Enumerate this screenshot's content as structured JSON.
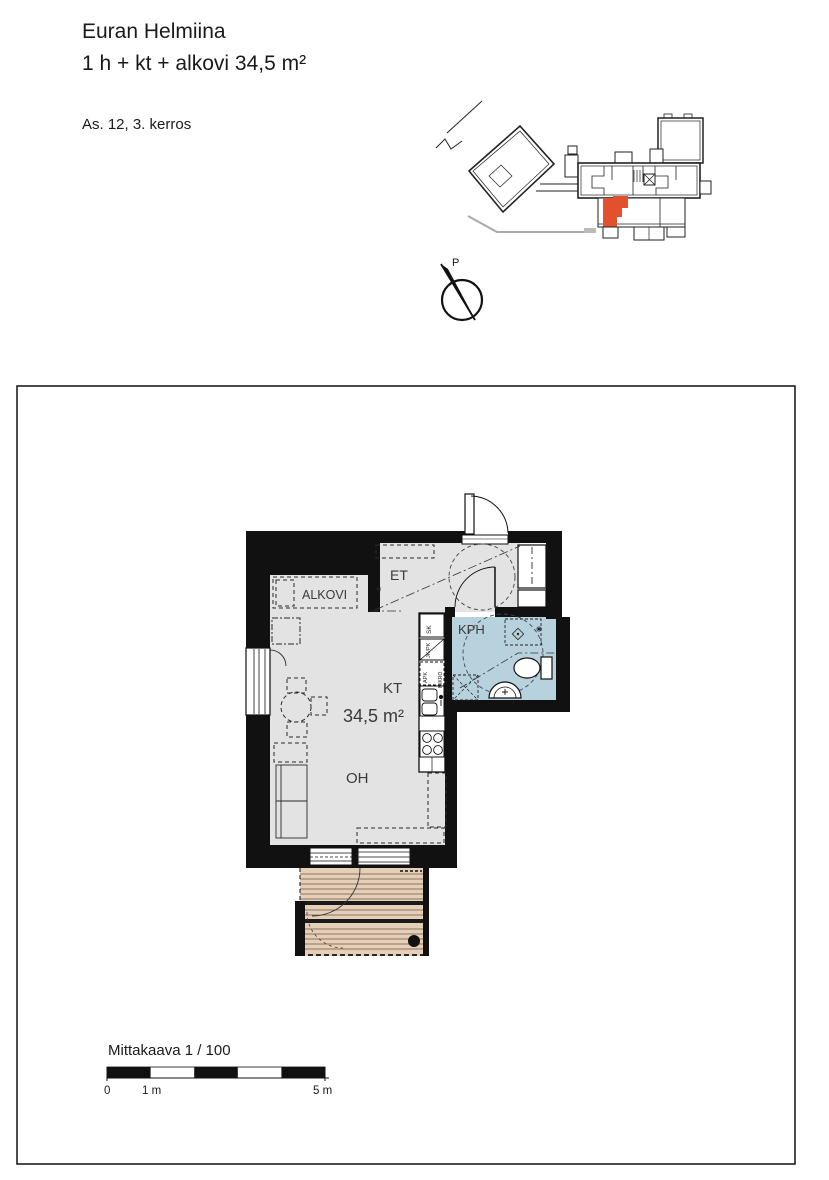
{
  "header": {
    "title": "Euran Helmiina",
    "subtitle": "1 h + kt + alkovi 34,5 m²",
    "unit_info": "As. 12, 3. kerros"
  },
  "site_plan": {
    "north_label": "P"
  },
  "floor_plan": {
    "rooms": {
      "et": "ET",
      "alkovi": "ALKOVI",
      "kph": "KPH",
      "kt": "KT",
      "oh": "OH"
    },
    "area_label": "34,5 m²",
    "appliances": {
      "sk": "SK",
      "jk_pk": "JK/PK",
      "apk": "APK",
      "mikro": "MIKRO"
    },
    "colors": {
      "wall": "#111111",
      "floor": "#e3e3e3",
      "bathroom": "#b7d2dc",
      "balcony": "#e6cfb8",
      "balcony_stripe": "#8a7560",
      "highlight": "#e2502e"
    }
  },
  "scale_bar": {
    "caption": "Mittakaava 1 / 100",
    "tick_0": "0",
    "tick_1": "1 m",
    "tick_5": "5 m"
  }
}
